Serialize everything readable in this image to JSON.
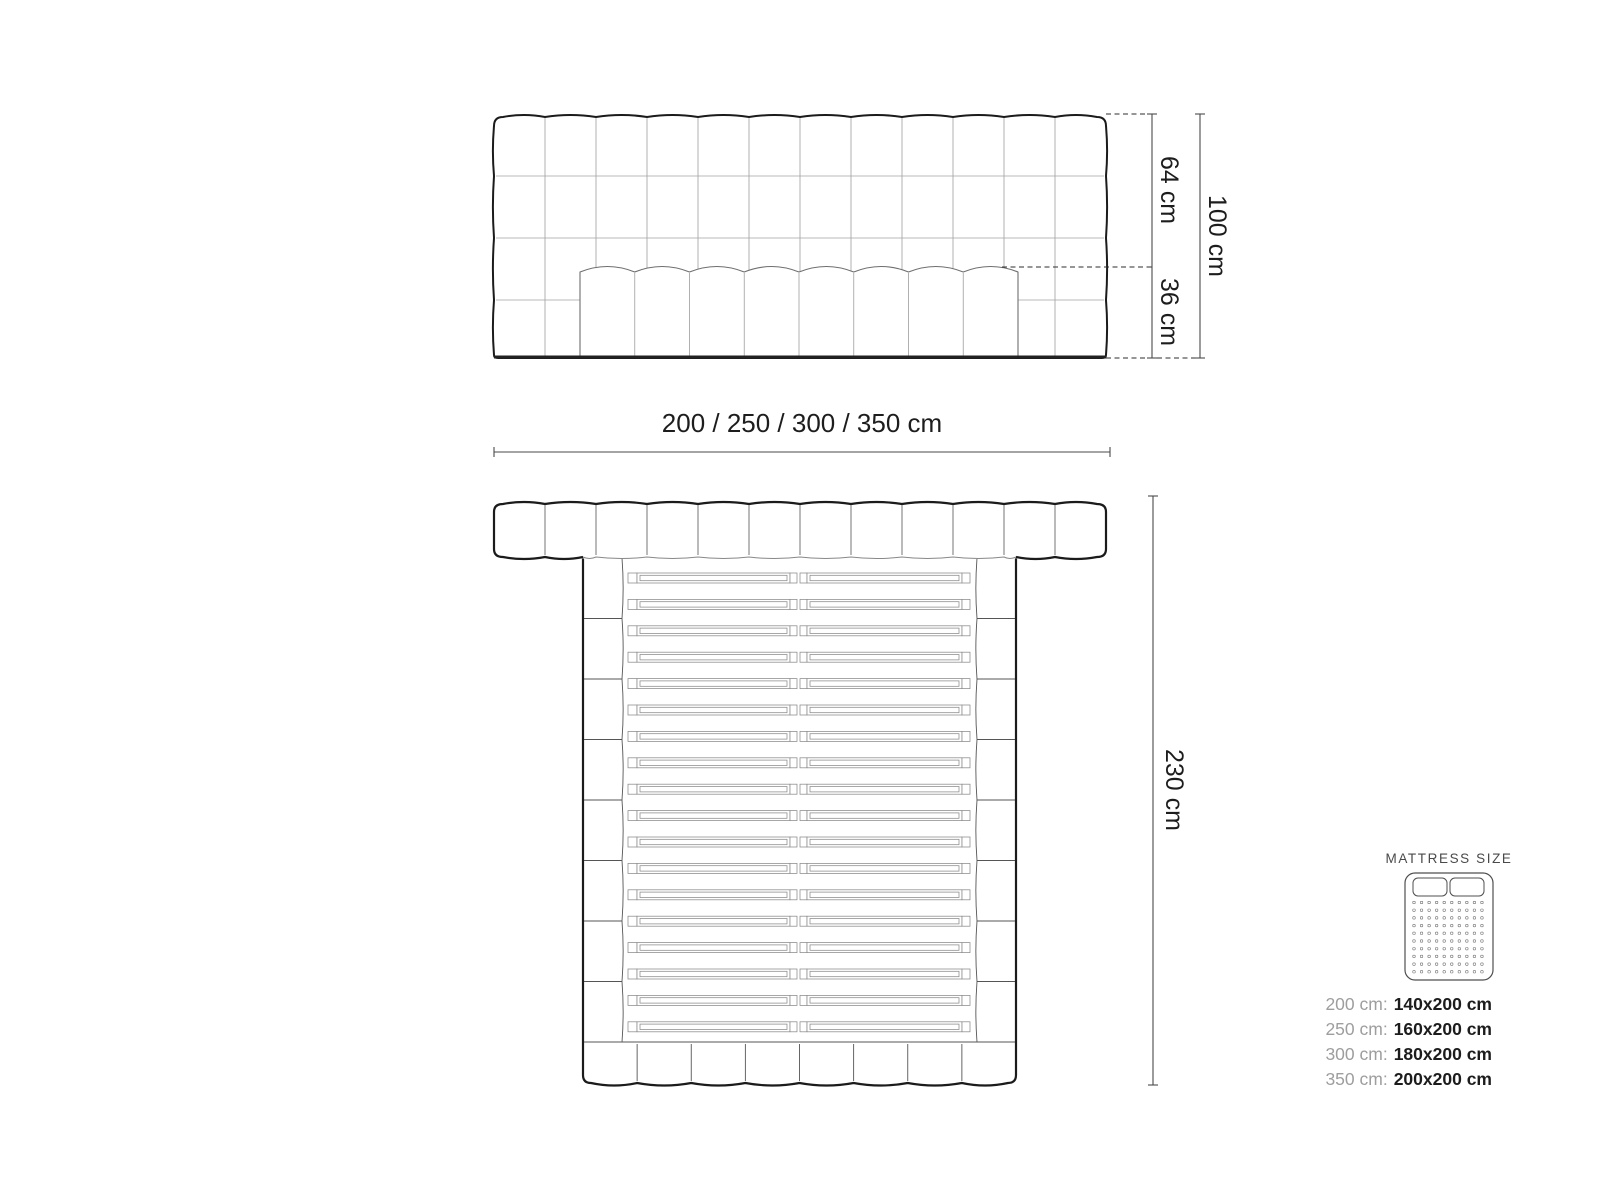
{
  "front_view": {
    "dim_headboard_above_mattress": "64 cm",
    "dim_mattress_height": "36 cm",
    "dim_total_height": "100 cm",
    "dim_width_options": "200 / 250 / 300 / 350 cm",
    "headboard": {
      "columns": 12,
      "rows": 4
    },
    "mattress": {
      "columns": 8
    }
  },
  "top_view": {
    "dim_total_length": "230 cm",
    "headboard_columns": 12,
    "rail_segments": 8,
    "slat_count": 18,
    "footboard_columns": 8
  },
  "legend": {
    "title": "MATTRESS SIZE",
    "icon": {
      "pillow_count": 2,
      "dot_rows": 10,
      "dot_cols": 10
    },
    "sizes": [
      {
        "label": "200 cm:",
        "value": "140x200 cm"
      },
      {
        "label": "250 cm:",
        "value": "160x200 cm"
      },
      {
        "label": "300 cm:",
        "value": "180x200 cm"
      },
      {
        "label": "350 cm:",
        "value": "200x200 cm"
      }
    ]
  },
  "colors": {
    "outline_thick": "#1b1b1b",
    "outline_thin": "#6e6e6e",
    "grid_line": "#a3a3a3",
    "slat_line": "#8a8a8a",
    "dim_line": "#4a4a4a",
    "text_dark": "#1d1d1d",
    "text_gray": "#9e9e9e"
  }
}
